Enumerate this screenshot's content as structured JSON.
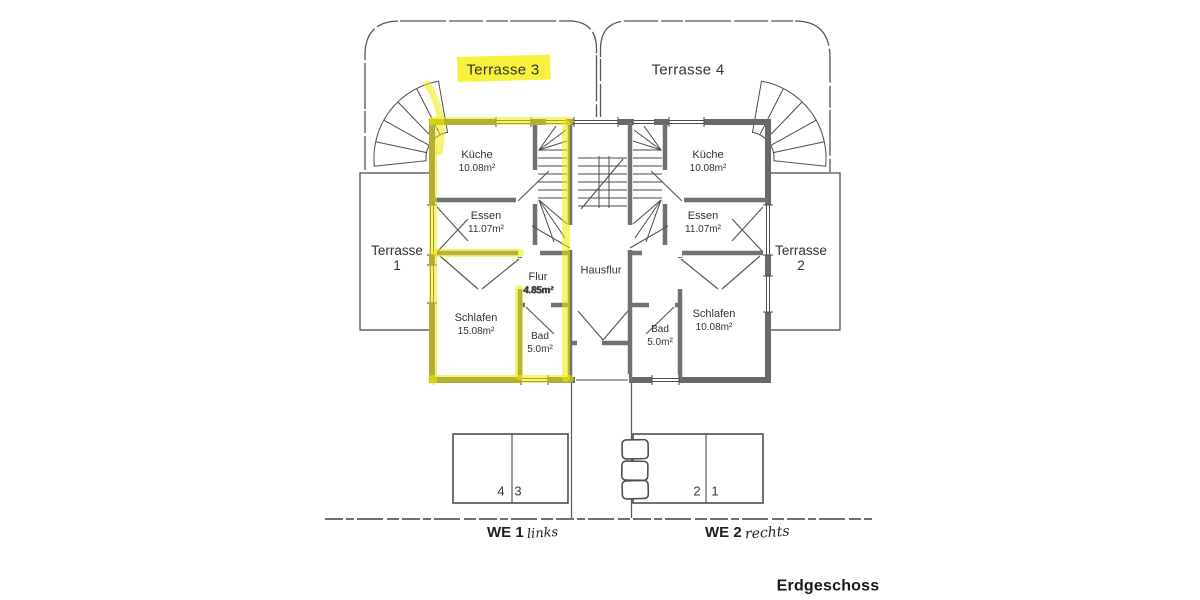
{
  "page": {
    "floor_label": "Erdgeschoss"
  },
  "colors": {
    "highlight": "#f3ee0c",
    "wall": "#696969",
    "line": "#4f4f4f",
    "text": "#333333"
  },
  "terraces": {
    "t3": {
      "label": "Terrasse 3",
      "highlighted": true
    },
    "t4": {
      "label": "Terrasse 4",
      "highlighted": false
    },
    "t1": {
      "line1": "Terrasse",
      "line2": "1"
    },
    "t2": {
      "line1": "Terrasse",
      "line2": "2"
    }
  },
  "hausflur": {
    "label": "Hausflur"
  },
  "unit_left": {
    "kueche": {
      "name": "Küche",
      "area": "10.08m²"
    },
    "essen": {
      "name": "Essen",
      "area": "11.07m²"
    },
    "flur": {
      "name": "Flur",
      "area": "4.85m²"
    },
    "schlafen": {
      "name": "Schlafen",
      "area": "15.08m²"
    },
    "bad": {
      "name": "Bad",
      "area": "5.0m²"
    }
  },
  "unit_right": {
    "kueche": {
      "name": "Küche",
      "area": "10.08m²"
    },
    "essen": {
      "name": "Essen",
      "area": "11.07m²"
    },
    "schlafen": {
      "name": "Schlafen",
      "area": "10.08m²"
    },
    "bad": {
      "name": "Bad",
      "area": "5.0m²"
    }
  },
  "parking": {
    "spots": [
      {
        "num": "4",
        "highlighted": true
      },
      {
        "num": "3",
        "highlighted": false
      },
      {
        "num": "2",
        "highlighted": false
      },
      {
        "num": "1",
        "highlighted": false
      }
    ]
  },
  "units": {
    "we1": {
      "label": "WE 1",
      "suffix": "links"
    },
    "we2": {
      "label": "WE 2",
      "suffix": "rechts"
    }
  }
}
